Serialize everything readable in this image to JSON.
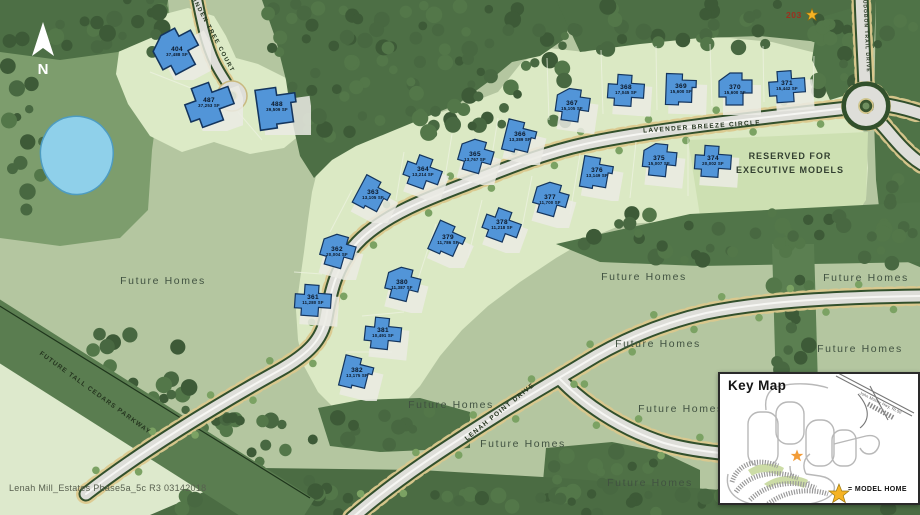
{
  "map": {
    "caption": "Lenah Mill_Estates Phase5a_5c R3 03142018",
    "north_label": "N",
    "model_home_marker": {
      "label": "203"
    },
    "reserved_area": {
      "line1": "RESERVED FOR",
      "line2": "EXECUTIVE MODELS"
    },
    "future_homes_label": "Future Homes",
    "future_homes_positions": [
      {
        "x": 163,
        "y": 281
      },
      {
        "x": 644,
        "y": 277
      },
      {
        "x": 866,
        "y": 278
      },
      {
        "x": 658,
        "y": 344
      },
      {
        "x": 860,
        "y": 349
      },
      {
        "x": 451,
        "y": 405
      },
      {
        "x": 523,
        "y": 444
      },
      {
        "x": 681,
        "y": 409
      },
      {
        "x": 650,
        "y": 483
      }
    ],
    "streets": [
      {
        "name": "LINDEN TREE COURT",
        "x": 212,
        "y": 34,
        "rot": 62,
        "fs": 6,
        "ls": 1.4
      },
      {
        "name": "LAVENDER BREEZE CIRCLE",
        "x": 702,
        "y": 127,
        "rot": -4,
        "fs": 6.5,
        "ls": 1.3
      },
      {
        "name": "AUDOBON TRAIL DRIVE",
        "x": 866,
        "y": 34,
        "rot": 87,
        "fs": 5,
        "ls": 1
      },
      {
        "name": "LENAH POINT DRIVE",
        "x": 500,
        "y": 412,
        "rot": -39,
        "fs": 6.5,
        "ls": 1.3
      },
      {
        "name": "FUTURE TALL CEDARS PARKWAY",
        "x": 95,
        "y": 393,
        "rot": 36,
        "fs": 6.5,
        "ls": 1.1
      }
    ],
    "lots": [
      {
        "num": "404",
        "sf": "37,488 SF",
        "x": 177,
        "y": 52,
        "rot": -28,
        "big": true
      },
      {
        "num": "487",
        "sf": "37,253 SF",
        "x": 209,
        "y": 103,
        "rot": -20,
        "big": true
      },
      {
        "num": "488",
        "sf": "39,509 SF",
        "x": 277,
        "y": 107,
        "rot": -8,
        "big": true
      },
      {
        "num": "367",
        "sf": "15,105 SF",
        "x": 572,
        "y": 106,
        "rot": 8
      },
      {
        "num": "368",
        "sf": "17,045 SF",
        "x": 626,
        "y": 90,
        "rot": 4
      },
      {
        "num": "369",
        "sf": "15,600 SF",
        "x": 681,
        "y": 89,
        "rot": 2
      },
      {
        "num": "370",
        "sf": "15,600 SF",
        "x": 735,
        "y": 90,
        "rot": 0
      },
      {
        "num": "371",
        "sf": "15,442 SF",
        "x": 787,
        "y": 86,
        "rot": -4
      },
      {
        "num": "366",
        "sf": "13,389 SF",
        "x": 520,
        "y": 137,
        "rot": 14
      },
      {
        "num": "365",
        "sf": "13,767 SF",
        "x": 475,
        "y": 157,
        "rot": 16
      },
      {
        "num": "364",
        "sf": "13,214 SF",
        "x": 423,
        "y": 172,
        "rot": 20
      },
      {
        "num": "363",
        "sf": "13,105 SF",
        "x": 373,
        "y": 195,
        "rot": 28
      },
      {
        "num": "362",
        "sf": "20,004 SF",
        "x": 337,
        "y": 252,
        "rot": 16
      },
      {
        "num": "361",
        "sf": "11,280 SF",
        "x": 313,
        "y": 300,
        "rot": 4
      },
      {
        "num": "376",
        "sf": "13,149 SF",
        "x": 597,
        "y": 173,
        "rot": 10
      },
      {
        "num": "377",
        "sf": "11,700 SF",
        "x": 550,
        "y": 200,
        "rot": 16
      },
      {
        "num": "378",
        "sf": "11,218 SF",
        "x": 502,
        "y": 225,
        "rot": 20
      },
      {
        "num": "379",
        "sf": "11,786 SF",
        "x": 448,
        "y": 240,
        "rot": 24
      },
      {
        "num": "380",
        "sf": "11,387 SF",
        "x": 402,
        "y": 285,
        "rot": 14
      },
      {
        "num": "381",
        "sf": "10,491 SF",
        "x": 383,
        "y": 333,
        "rot": 6
      },
      {
        "num": "382",
        "sf": "13,175 SF",
        "x": 357,
        "y": 373,
        "rot": 14
      },
      {
        "num": "375",
        "sf": "15,007 SF",
        "x": 659,
        "y": 161,
        "rot": 6
      },
      {
        "num": "374",
        "sf": "20,002 SF",
        "x": 713,
        "y": 161,
        "rot": 4
      }
    ],
    "colors": {
      "house_fill": "#5295d8",
      "house_outline": "#14355e",
      "water": "#8fd0ea",
      "model_home_star": "#f5b324",
      "pavement": "#deded9"
    }
  },
  "key_map": {
    "title": "Key Map",
    "highway_label": "John Mosby Hwy.  Rt.50",
    "legend": {
      "symbol": "model-home-star",
      "label": "= MODEL HOME"
    }
  }
}
